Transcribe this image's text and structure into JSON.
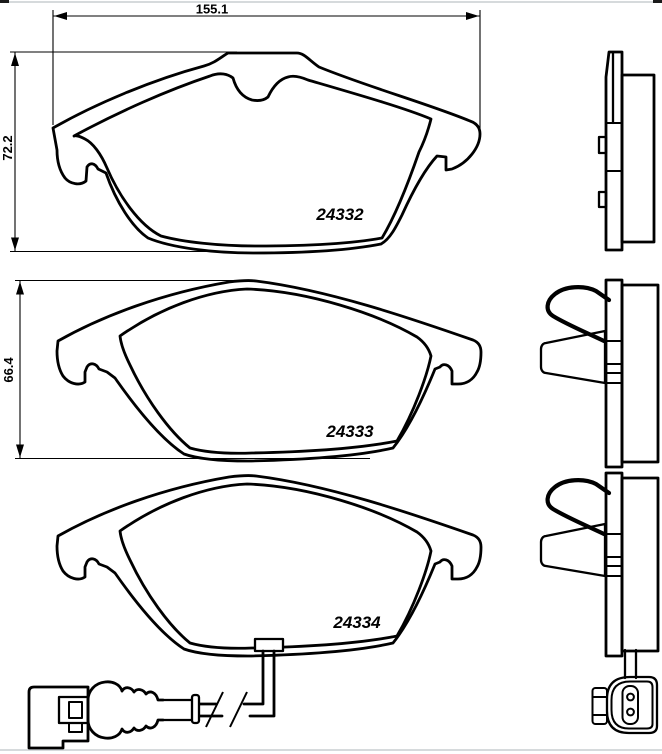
{
  "drawing": {
    "dimensions": {
      "pad1_width_mm": "155.1",
      "pad1_height_mm": "72.2",
      "pad2_height_mm": "66.4"
    },
    "part_numbers": {
      "pad1": "24332",
      "pad2": "24333",
      "pad3": "24334"
    },
    "colors": {
      "line": "#000000",
      "background": "#ffffff",
      "page_edge_rule": "#c9cdd1"
    }
  }
}
